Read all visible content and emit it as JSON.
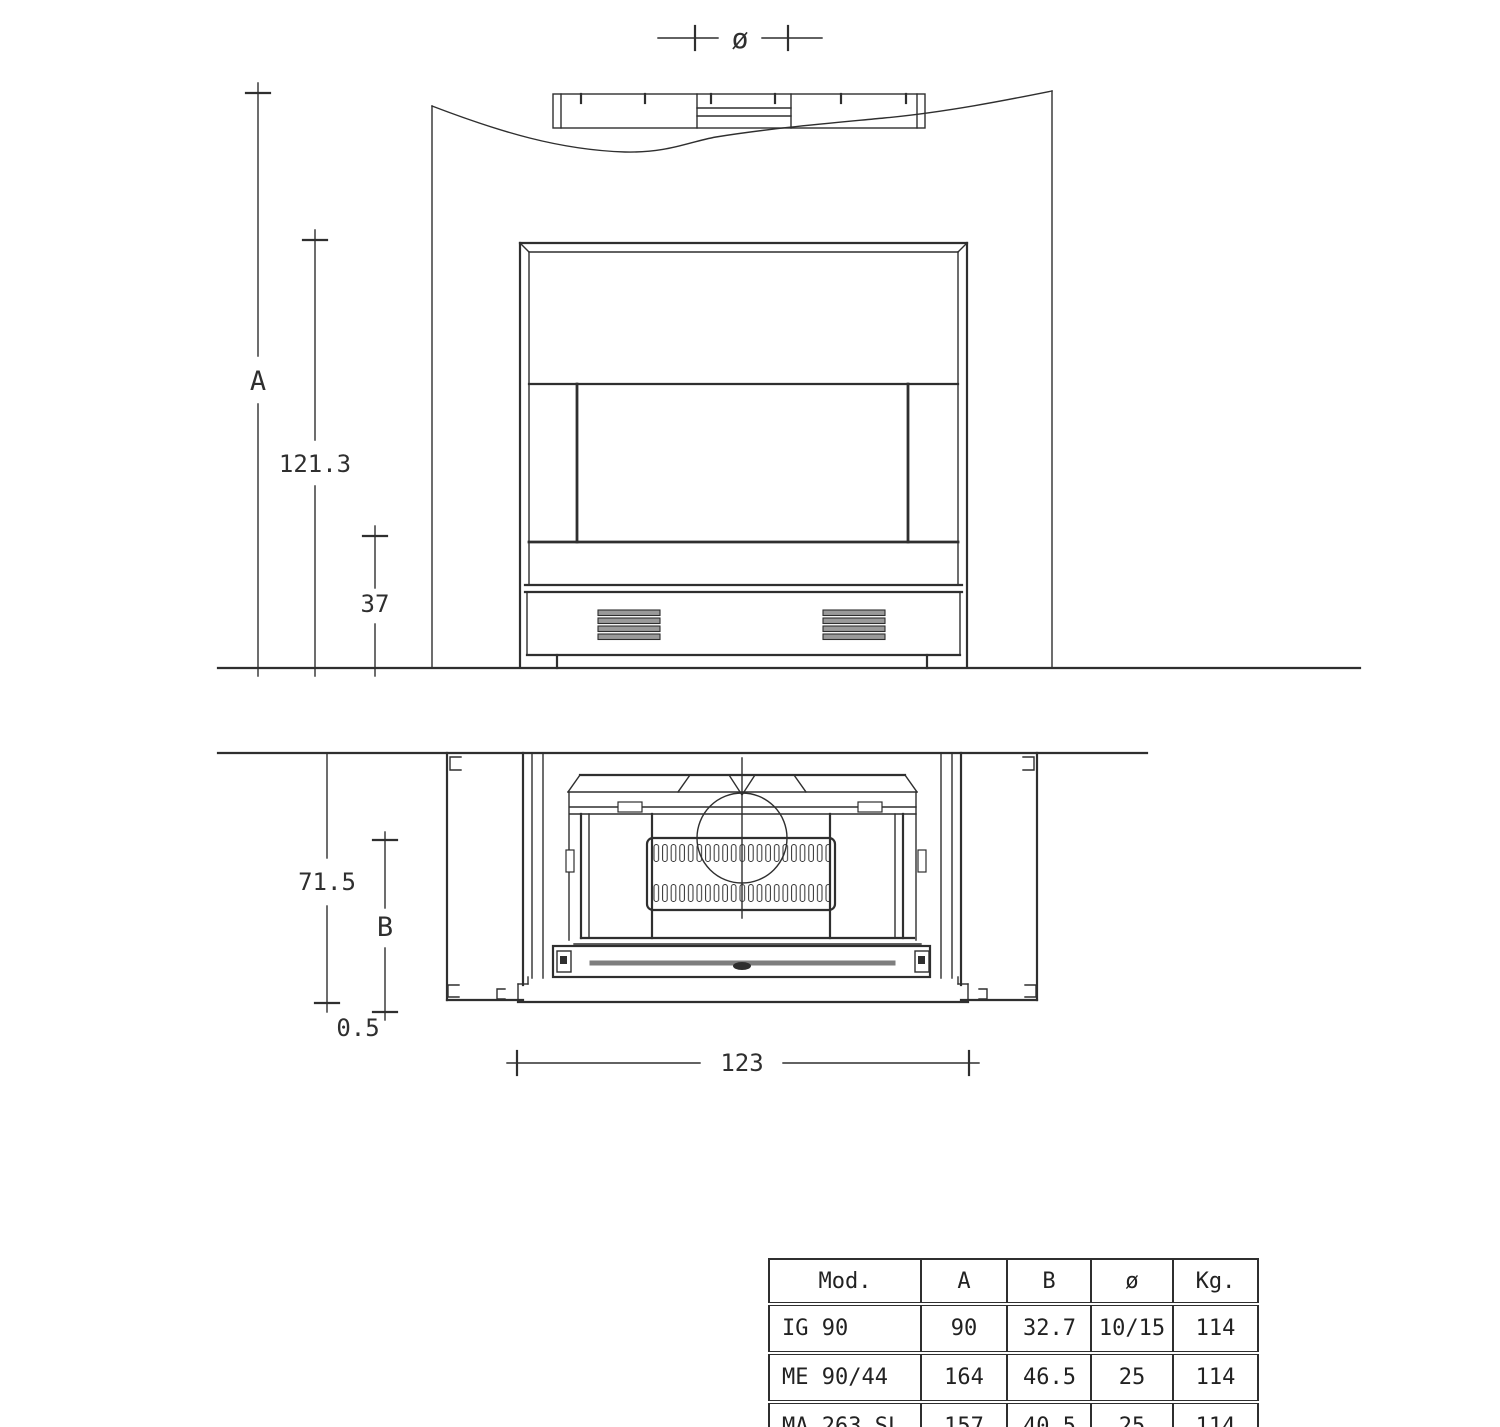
{
  "drawing": {
    "front_view": {
      "dim_diameter": "ø",
      "dim_a": "A",
      "dim_height": "121.3",
      "dim_hearth": "37"
    },
    "plan_view": {
      "dim_depth": "71.5",
      "dim_b": "B",
      "dim_offset": "0.5",
      "dim_width": "123"
    }
  },
  "table": {
    "headers": [
      "Mod.",
      "A",
      "B",
      "ø",
      "Kg."
    ],
    "rows": [
      [
        "IG 90",
        "90",
        "32.7",
        "10/15",
        "114"
      ],
      [
        "ME 90/44",
        "164",
        "46.5",
        "25",
        "114"
      ],
      [
        "MA 263 SL",
        "157",
        "40.5",
        "25",
        "114"
      ]
    ]
  },
  "colors": {
    "line": "#2f2f2f",
    "slot_fill": "#454545",
    "slat_fill": "#9a9a9a",
    "metal_gray": "#7e7e7e",
    "bg": "#ffffff"
  }
}
